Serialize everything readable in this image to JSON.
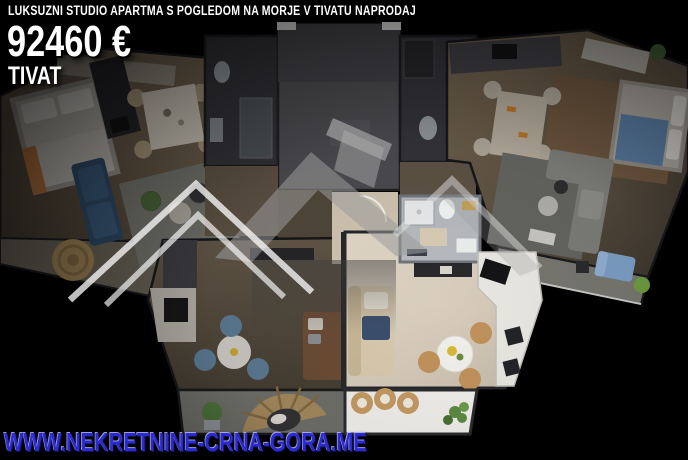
{
  "listing": {
    "title": "LUKSUZNI STUDIO APARTMA S POGLEDOM NA MORJE V TIVATU NAPRODAJ",
    "price": "92460 €",
    "location": "TIVAT",
    "website_url": "WWW.NEKRETNINE-CRNA-GORA.ME"
  },
  "render": {
    "subject": "top-down 3D floor plan of apartment building, center studio unit brightly highlighted",
    "watermark_icon": "house-roof-logo"
  },
  "colors": {
    "background": "#000000",
    "heading_text": "#ffffff",
    "website_text": "#2b2bd0",
    "highlight_floor": "#d7ccbc",
    "dimmed_floor": "#5f5446",
    "watermark_grey": "#9b9b9b"
  }
}
